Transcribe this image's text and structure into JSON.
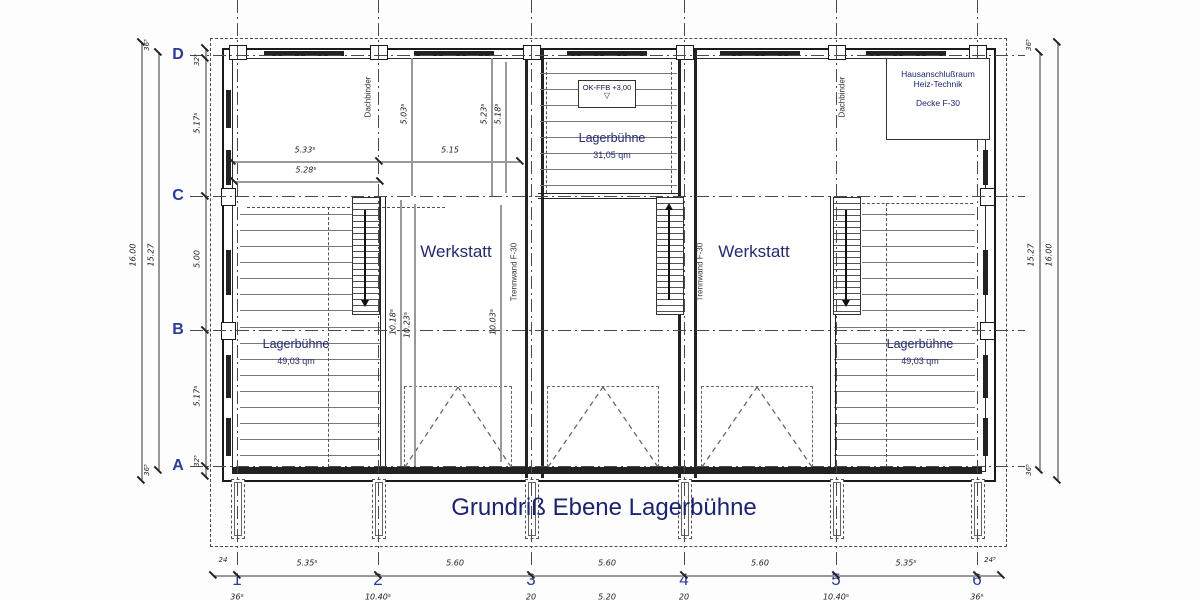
{
  "title": "Grundriß Ebene Lagerbühne",
  "grid": {
    "rows": [
      "D",
      "C",
      "B",
      "A"
    ],
    "cols": [
      "1",
      "2",
      "3",
      "4",
      "5",
      "6"
    ]
  },
  "rooms": {
    "werkstatt": "Werkstatt",
    "lager_side": {
      "name": "Lagerbühne",
      "area": "49,03 qm"
    },
    "lager_center": {
      "name": "Lagerbühne",
      "area": "31,05 qm"
    },
    "haus": {
      "line1": "Hausanschlußraum",
      "line2": "Heiz-Technik",
      "line3": "Decke F-30"
    }
  },
  "annotations": {
    "level_marker": "OK-FFB +3,00",
    "level_triangle": "▽",
    "dachbinder": "Dachbinder",
    "trennwand": "Trennwand F-30"
  },
  "dims": {
    "bottom_row1": [
      "24",
      "5.35⁵",
      "5.60",
      "5.60",
      "5.60",
      "5.35⁵",
      "24⁵"
    ],
    "bottom_row2": [
      "36⁵",
      "10.40⁵",
      "20",
      "5.20",
      "20",
      "10.40⁵",
      "36⁵"
    ],
    "left_outer": {
      "overall": "16.00",
      "inner": "15.27",
      "wall_top": "36⁵",
      "wall_bottom": "36⁵"
    },
    "right_outer": {
      "overall": "16.00",
      "inner": "15.27",
      "wall_top": "36⁵",
      "wall_bottom": "36⁵"
    },
    "left_inner": [
      "32⁵",
      "5.17⁵",
      "5.00",
      "5.17⁵",
      "32⁵"
    ],
    "interior_h": [
      "5.33⁵",
      "5.28⁵",
      "5.15"
    ],
    "interior_v_top": [
      "5.03⁵",
      "5.23⁵",
      "5.18⁵"
    ],
    "interior_v_mid": [
      "10.18⁵",
      "10.23⁵",
      "10.03⁵"
    ]
  },
  "colors": {
    "label_navy": "#232a6e",
    "grid_blue": "#2c3a96",
    "line_dark": "#1a1a1a",
    "dim_gray": "#999999"
  }
}
